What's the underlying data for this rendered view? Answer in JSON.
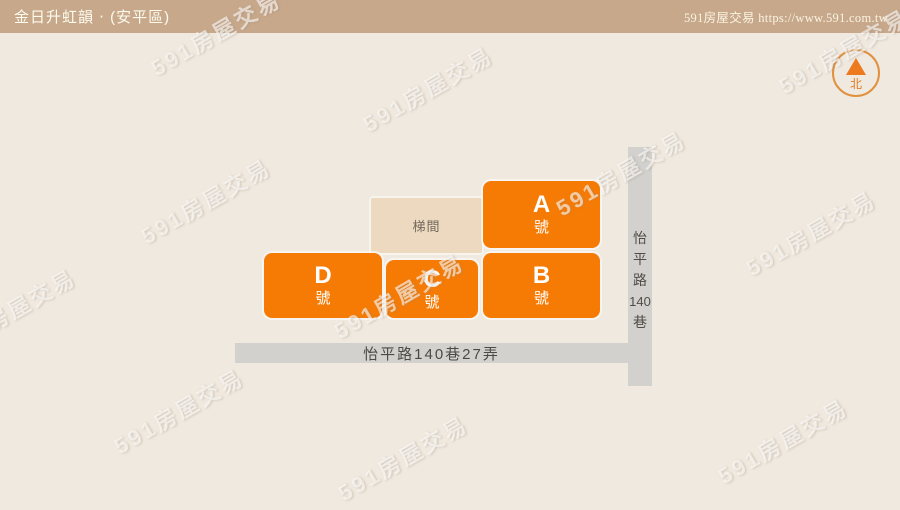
{
  "header": {
    "title": "金日升虹韻 ‧ (安平區)",
    "site_credit": "591房屋交易 https://www.591.com.tw"
  },
  "compass": {
    "north_label": "北"
  },
  "watermark": {
    "text": "591房屋交易"
  },
  "stairwell": {
    "label": "梯間"
  },
  "buildings": [
    {
      "letter": "A",
      "suffix": "號"
    },
    {
      "letter": "B",
      "suffix": "號"
    },
    {
      "letter": "C",
      "suffix": "號"
    },
    {
      "letter": "D",
      "suffix": "號"
    }
  ],
  "roads": {
    "vertical": {
      "label": "怡平路140巷",
      "chars": [
        "怡",
        "平",
        "路",
        "140",
        "巷"
      ]
    },
    "horizontal": {
      "label": "怡平路140巷27弄"
    }
  },
  "colors": {
    "header_bg": "#c7a88b",
    "background": "#f0e9df",
    "building_orange": "#f57b05",
    "stairwell_bg": "#ecd9c0",
    "road_gray": "#d2d1cd",
    "compass_accent": "#e0913e"
  }
}
